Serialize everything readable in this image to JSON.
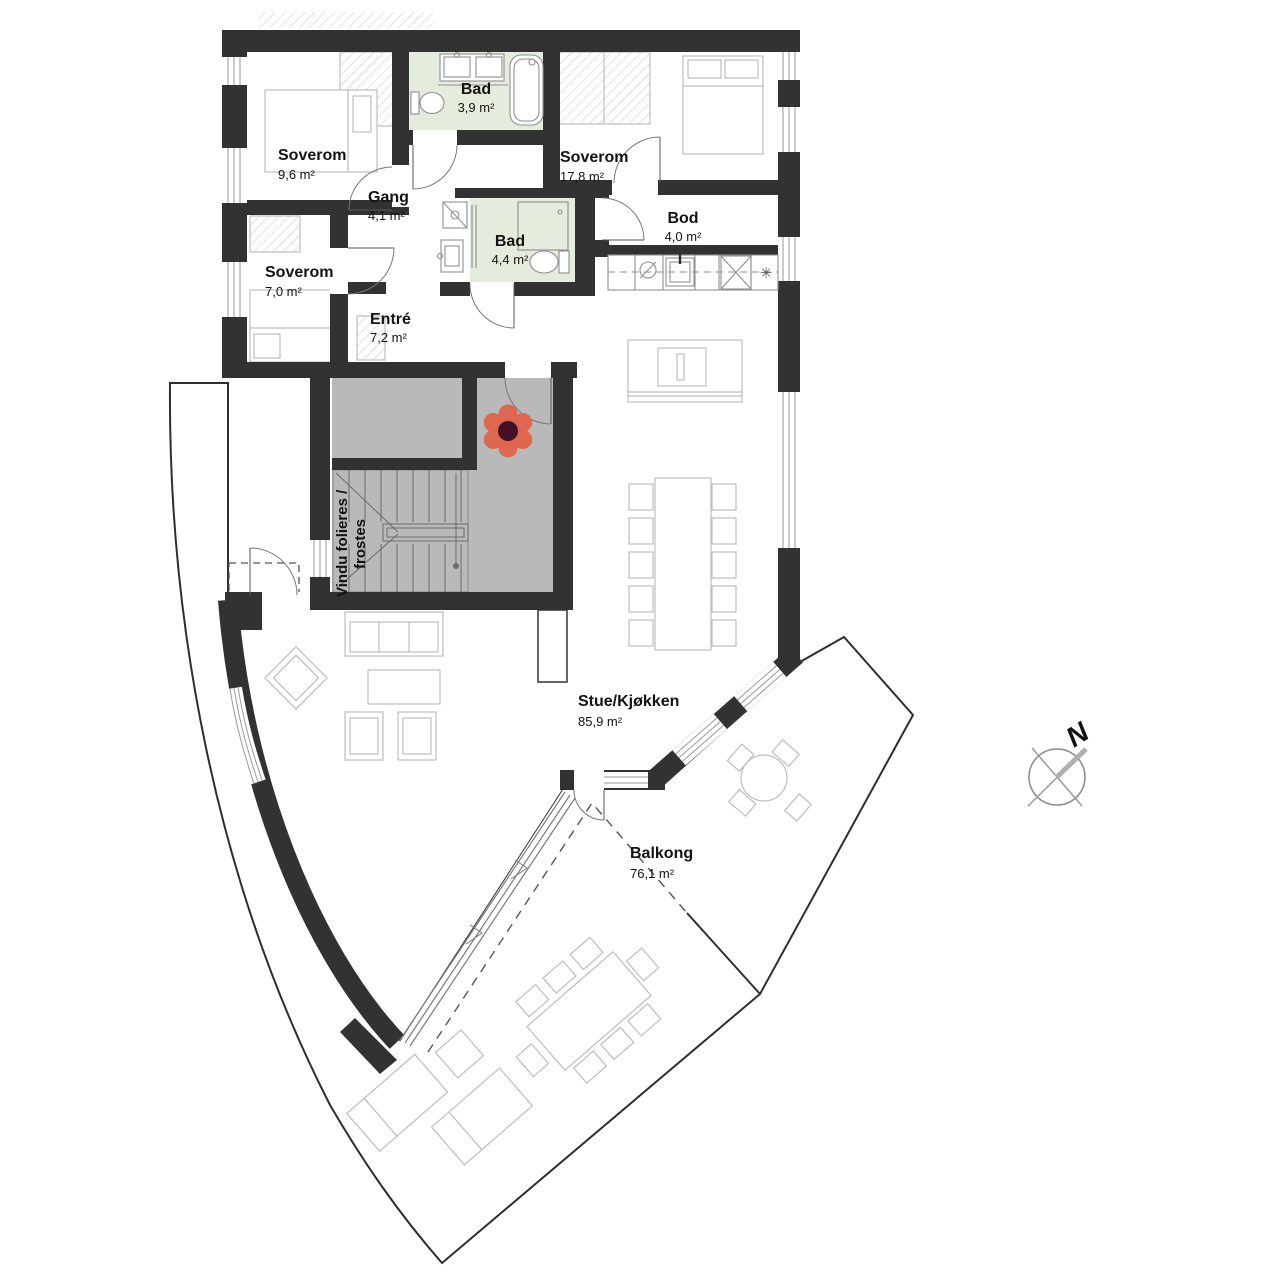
{
  "plan": {
    "rooms": [
      {
        "id": "soverom-1",
        "name": "Soverom",
        "area": "9,6 m²"
      },
      {
        "id": "bad-1",
        "name": "Bad",
        "area": "3,9 m²"
      },
      {
        "id": "soverom-2",
        "name": "Soverom",
        "area": "17,8 m²"
      },
      {
        "id": "gang",
        "name": "Gang",
        "area": "4,1 m²"
      },
      {
        "id": "bad-2",
        "name": "Bad",
        "area": "4,4 m²"
      },
      {
        "id": "bod",
        "name": "Bod",
        "area": "4,0 m²"
      },
      {
        "id": "soverom-3",
        "name": "Soverom",
        "area": "7,0 m²"
      },
      {
        "id": "entre",
        "name": "Entré",
        "area": "7,2 m²"
      },
      {
        "id": "stue-kjokken",
        "name": "Stue/Kjøkken",
        "area": "85,9 m²"
      },
      {
        "id": "balkong",
        "name": "Balkong",
        "area": "76,1 m²"
      }
    ],
    "notes": {
      "window_note_line1": "Vindu folieres /",
      "window_note_line2": "frostes"
    },
    "compass": {
      "north_label": "N"
    },
    "icons": {
      "snowflake": "✳"
    },
    "colors": {
      "wall": "#323232",
      "bathroom_floor": "#e4ecdd",
      "common_area": "#b9b9b9",
      "flower_petal": "#e0674f",
      "flower_center": "#431027",
      "furniture_outline": "#bdbdbd"
    }
  }
}
